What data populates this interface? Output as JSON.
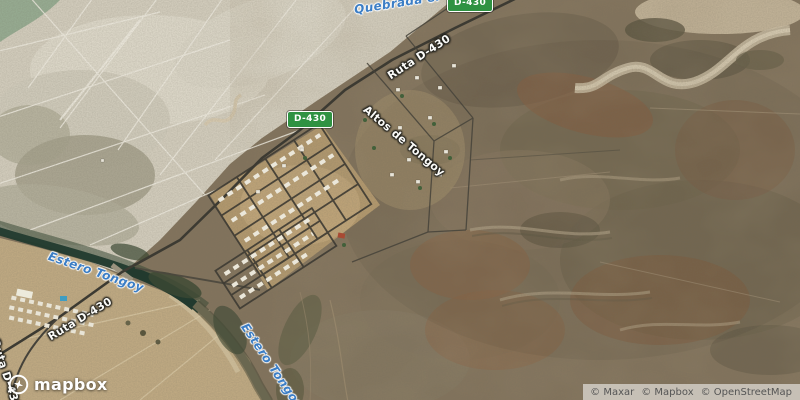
{
  "map": {
    "shields": {
      "top": "D-430",
      "middle": "D-430"
    },
    "labels": {
      "waterway_top": "Quebrada el",
      "route_top": "Ruta D-430",
      "district": "Altos de Tongoy",
      "estero_upper": "Estero Tongoy",
      "route_lower": "Ruta D-430",
      "estero_lower": "Estero Tongoy",
      "route_edge": "Ruta D-430"
    },
    "logo": "mapbox",
    "attribution": [
      "© Maxar",
      "© Mapbox",
      "© OpenStreetMap"
    ],
    "colors": {
      "shield_green": "#2f9242",
      "water_label_blue": "#3c7ec5",
      "road_label_white": "#ffffff"
    }
  }
}
